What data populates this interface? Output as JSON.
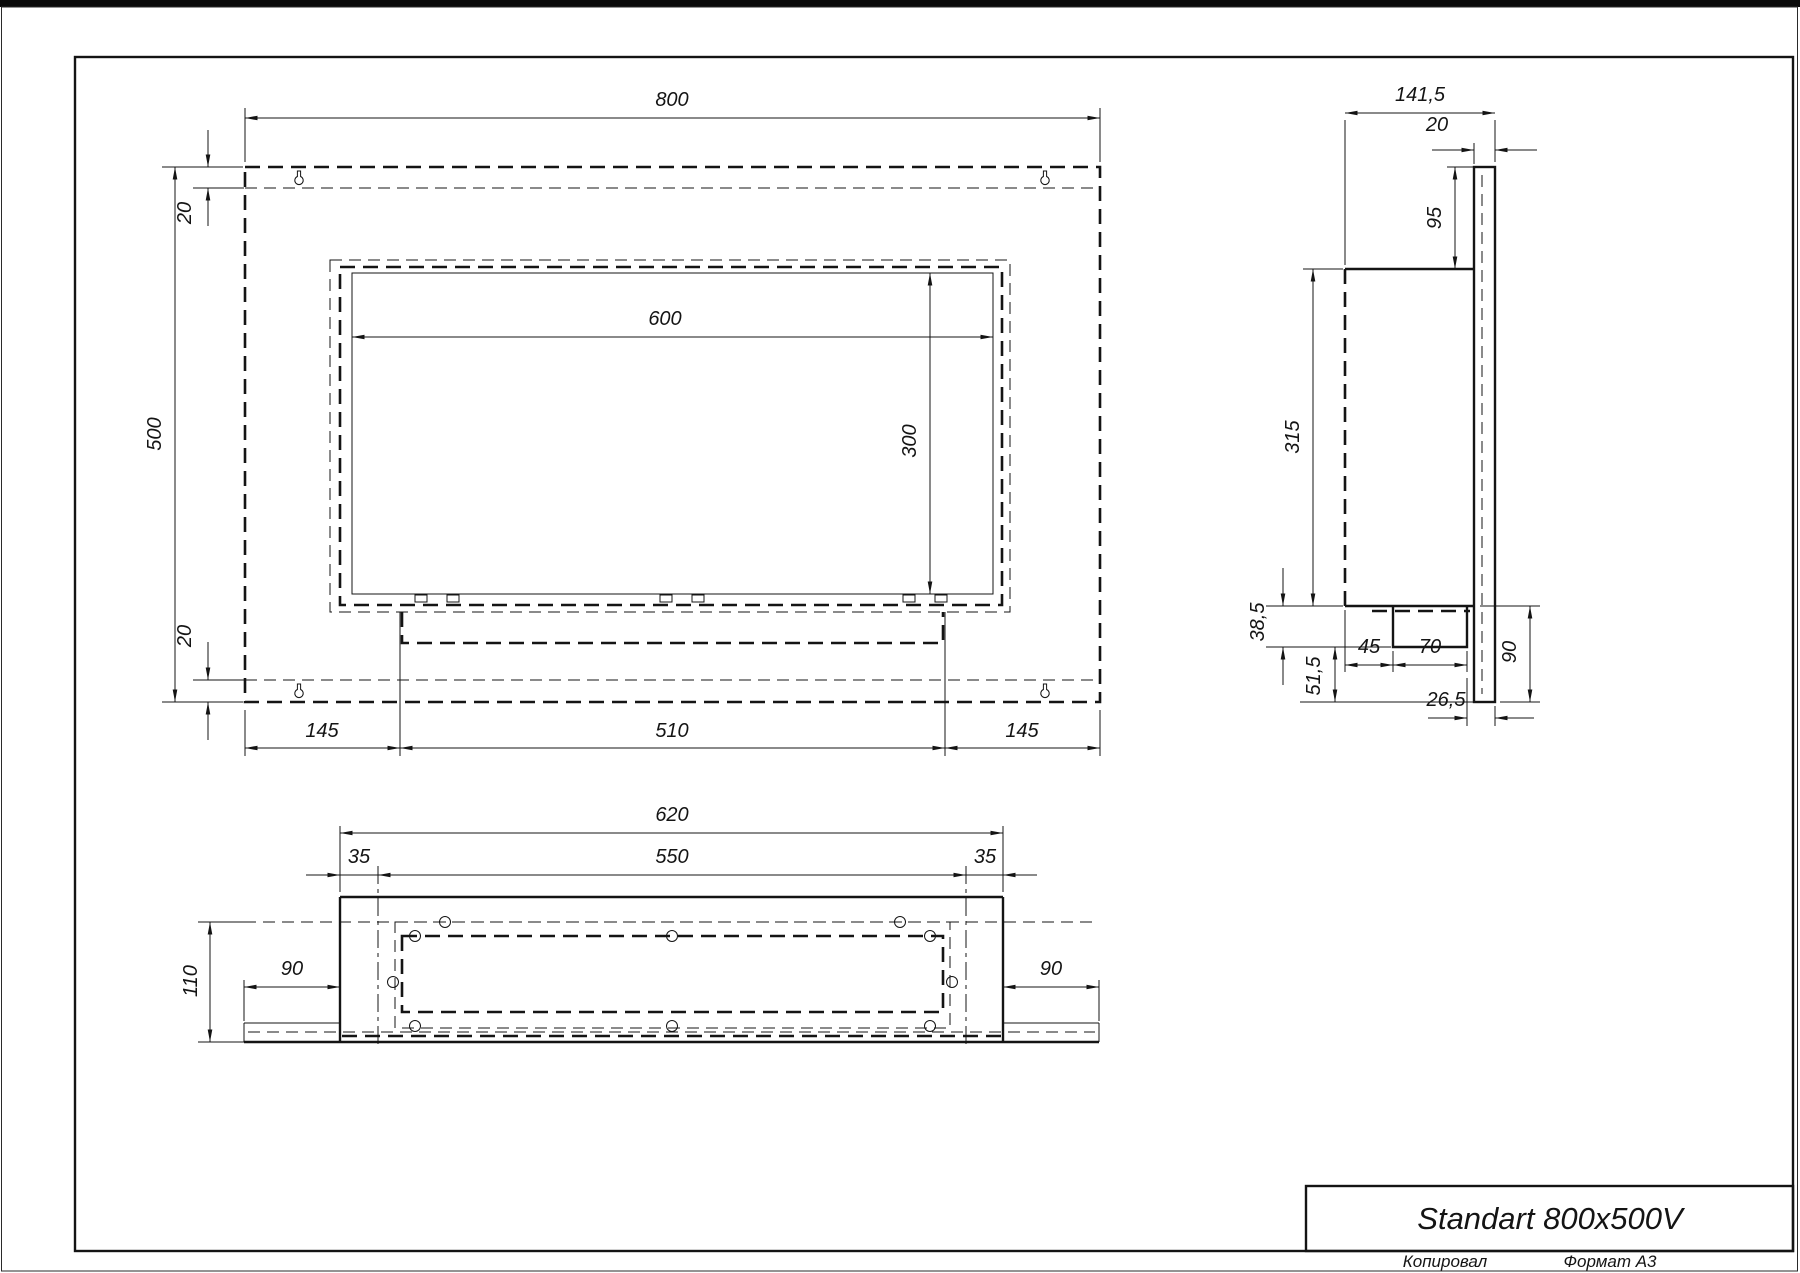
{
  "drawing": {
    "title": "Standart 800x500V",
    "footer": {
      "copied_by": "Копировал",
      "format": "Формат А3"
    }
  },
  "front_view": {
    "dims": {
      "width": "800",
      "height": "500",
      "offset_top": "20",
      "offset_bottom": "20",
      "opening_width": "600",
      "opening_height": "300",
      "margin_left": "145",
      "tray_width": "510",
      "margin_right": "145"
    }
  },
  "side_view": {
    "dims": {
      "depth": "141,5",
      "plate_thickness": "20",
      "top_to_body": "95",
      "body_height": "315",
      "burner_drop": "38,5",
      "bottom_drop": "51,5",
      "burner_offset": "45",
      "burner_depth": "70",
      "back_gap": "26,5",
      "plate_bottom": "90"
    }
  },
  "bottom_view": {
    "dims": {
      "body_width": "620",
      "inner_width": "550",
      "inset_left": "35",
      "inset_right": "35",
      "depth": "110",
      "wing_left": "90",
      "wing_right": "90"
    }
  },
  "colors": {
    "ink": "#141414",
    "paper": "#ffffff"
  }
}
